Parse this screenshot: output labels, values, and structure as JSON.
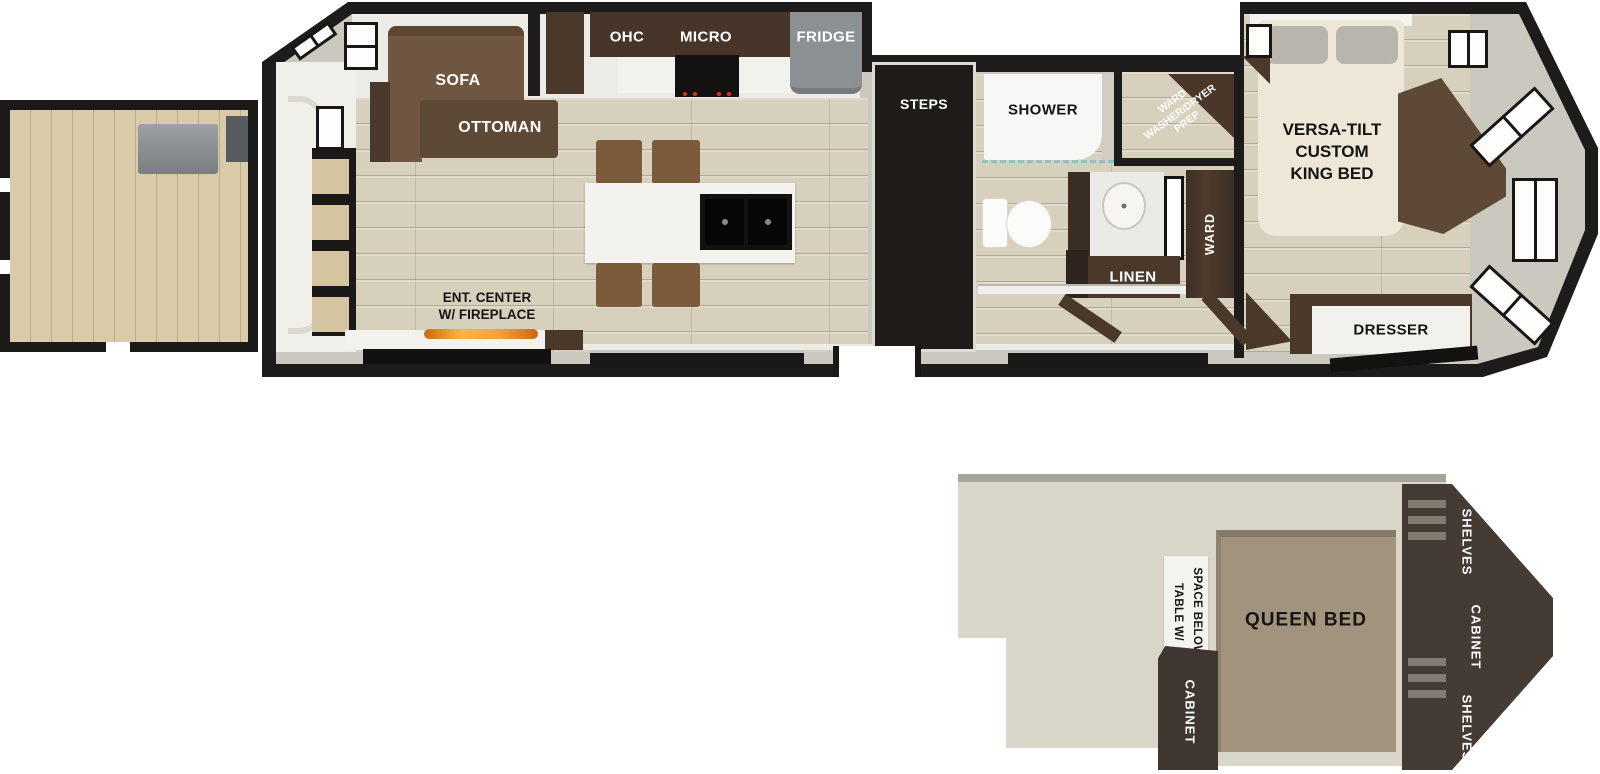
{
  "main_floor": {
    "sofa": "SOFA",
    "ottoman": "OTTOMAN",
    "ohc": "OHC",
    "micro": "MICRO",
    "fridge": "FRIDGE",
    "steps": "STEPS",
    "shower": "SHOWER",
    "ward_prep": {
      "l1": "WARD",
      "l2": "WASHER/DRYER",
      "l3": "PREP"
    },
    "linen": "LINEN",
    "ward": "WARD",
    "king_bed": {
      "l1": "VERSA-TILT",
      "l2": "CUSTOM",
      "l3": "KING BED"
    },
    "dresser": "DRESSER",
    "ent_center": {
      "l1": "ENT. CENTER",
      "l2": "W/ FIREPLACE"
    }
  },
  "loft": {
    "table": {
      "l1": "TABLE W/",
      "l2": "SPACE BELOW"
    },
    "queen_bed": "QUEEN BED",
    "cabinet": "CABINET",
    "unit": {
      "shelves_top": "SHELVES",
      "cabinet": "CABINET",
      "shelves_bottom": "SHELVES"
    }
  },
  "colors": {
    "wall_black": "#1e1c1a",
    "wall_gray": "#cbc8c0",
    "floor_wood": "#d6d0bd",
    "deck_wood": "#d9cba7",
    "cabinet_brown": "#4a382b",
    "sofa_brown": "#6f5640",
    "fridge_gray": "#8d9092",
    "bed_cream": "#ece7d6",
    "queen_tan": "#a2947c",
    "loft_floor": "#dad6ca",
    "loft_unit": "#443b34",
    "flame_orange": "#f2a336"
  }
}
